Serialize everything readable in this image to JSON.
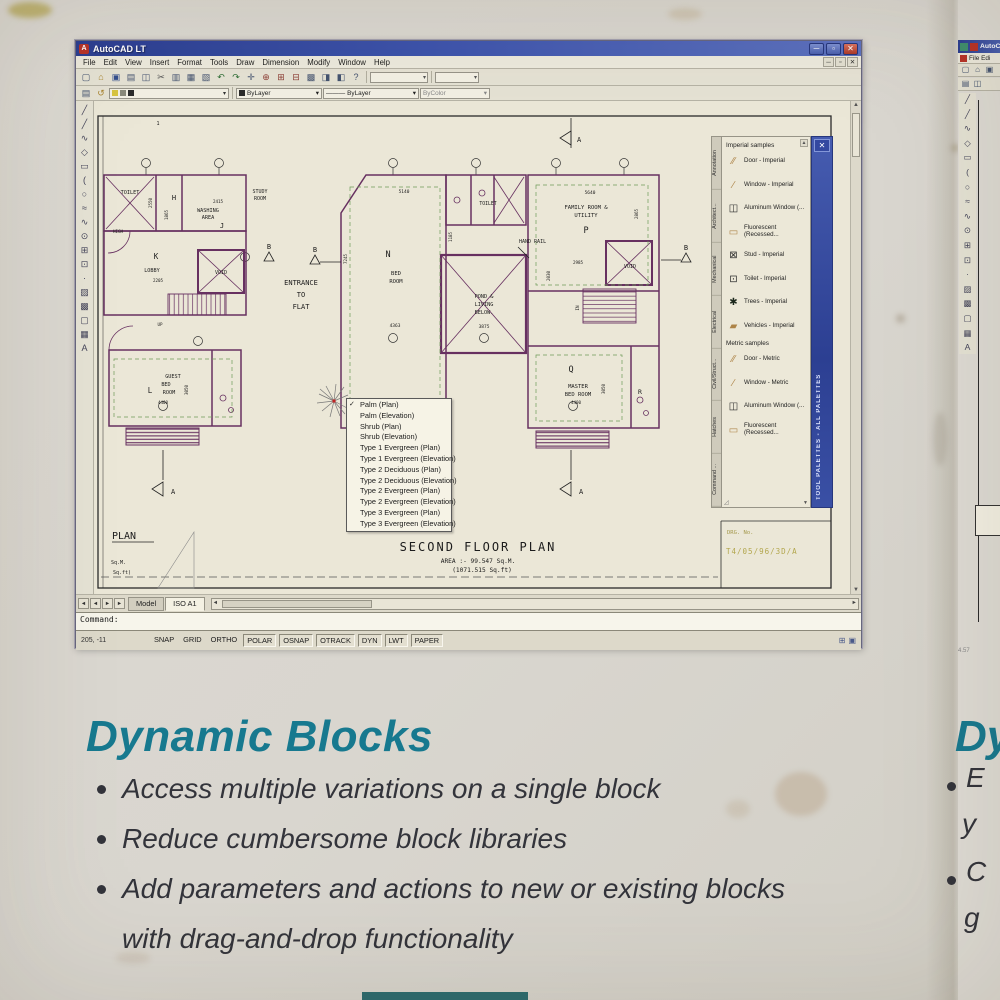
{
  "acad": {
    "title": "AutoCAD LT",
    "app_icon_letter": "A",
    "controls": {
      "minimize": "─",
      "restore": "▫",
      "close": "✕"
    },
    "doc_controls": {
      "minimize": "─",
      "restore": "▫",
      "close": "✕"
    },
    "menus": [
      "File",
      "Edit",
      "View",
      "Insert",
      "Format",
      "Tools",
      "Draw",
      "Dimension",
      "Modify",
      "Window",
      "Help"
    ],
    "toolbar1_icons": [
      {
        "name": "qnew-icon",
        "glyph": "▢"
      },
      {
        "name": "open-icon",
        "glyph": "⌂"
      },
      {
        "name": "save-icon",
        "glyph": "▣"
      },
      {
        "name": "plot-icon",
        "glyph": "▤"
      },
      {
        "name": "plot-preview-icon",
        "glyph": "◫"
      },
      {
        "name": "cut-icon",
        "glyph": "✂"
      },
      {
        "name": "copy-icon",
        "glyph": "▥"
      },
      {
        "name": "paste-icon",
        "glyph": "▦"
      },
      {
        "name": "match-properties-icon",
        "glyph": "▧"
      },
      {
        "name": "undo-icon",
        "glyph": "↶"
      },
      {
        "name": "redo-icon",
        "glyph": "↷"
      },
      {
        "name": "pan-icon",
        "glyph": "✛"
      },
      {
        "name": "zoom-realtime-icon",
        "glyph": "⊕"
      },
      {
        "name": "zoom-window-icon",
        "glyph": "⊞"
      },
      {
        "name": "zoom-previous-icon",
        "glyph": "⊟"
      },
      {
        "name": "properties-icon",
        "glyph": "▩"
      },
      {
        "name": "designcenter-icon",
        "glyph": "◨"
      },
      {
        "name": "tool-palettes-icon",
        "glyph": "◧"
      },
      {
        "name": "help-icon",
        "glyph": "?"
      }
    ],
    "combo_arrow": "▾",
    "layer_tools": [
      {
        "name": "layer-properties-icon",
        "glyph": "▤"
      },
      {
        "name": "layer-previous-icon",
        "glyph": "↺"
      }
    ],
    "properties": {
      "color_value": "ByLayer",
      "linetype_dash": "———",
      "linetype_value": "ByLayer",
      "plotstyle_value": "ByColor"
    },
    "draw_icons": [
      {
        "name": "line-icon",
        "glyph": "╱"
      },
      {
        "name": "construction-line-icon",
        "glyph": "╱"
      },
      {
        "name": "polyline-icon",
        "glyph": "∿"
      },
      {
        "name": "polygon-icon",
        "glyph": "◇"
      },
      {
        "name": "rectangle-icon",
        "glyph": "▭"
      },
      {
        "name": "arc-icon",
        "glyph": "("
      },
      {
        "name": "circle-icon",
        "glyph": "○"
      },
      {
        "name": "revision-cloud-icon",
        "glyph": "≈"
      },
      {
        "name": "spline-icon",
        "glyph": "∿"
      },
      {
        "name": "ellipse-icon",
        "glyph": "⊙"
      },
      {
        "name": "insert-block-icon",
        "glyph": "⊞"
      },
      {
        "name": "make-block-icon",
        "glyph": "⊡"
      },
      {
        "name": "point-icon",
        "glyph": "·"
      },
      {
        "name": "hatch-icon",
        "glyph": "▨"
      },
      {
        "name": "gradient-icon",
        "glyph": "▩"
      },
      {
        "name": "region-icon",
        "glyph": "▢"
      },
      {
        "name": "table-icon",
        "glyph": "▦"
      },
      {
        "name": "text-icon",
        "glyph": "A"
      }
    ],
    "command_text": "Command:",
    "tab_nav": [
      "◄",
      "◄",
      "►",
      "►"
    ],
    "tabs": {
      "model": "Model",
      "layout": "ISO A1"
    },
    "scroll": {
      "left": "◄",
      "right": "►",
      "up": "▲",
      "down": "▼"
    },
    "status": {
      "coords": "205, -11",
      "buttons": [
        {
          "label": "SNAP",
          "raised": false
        },
        {
          "label": "GRID",
          "raised": false
        },
        {
          "label": "ORTHO",
          "raised": false
        },
        {
          "label": "POLAR",
          "raised": true
        },
        {
          "label": "OSNAP",
          "raised": true
        },
        {
          "label": "OTRACK",
          "raised": true
        },
        {
          "label": "DYN",
          "raised": true
        },
        {
          "label": "LWT",
          "raised": true
        },
        {
          "label": "PAPER",
          "raised": true
        }
      ],
      "tray": [
        {
          "name": "toolbar-lock-icon",
          "glyph": "⊞"
        },
        {
          "name": "comm-center-icon",
          "glyph": "▣"
        }
      ]
    }
  },
  "palette": {
    "tabs": [
      "Annotation",
      "Architect...",
      "Mechanical",
      "Electrical",
      "Civil/Struct...",
      "Hatches",
      "Command ..."
    ],
    "bar_label": "TOOL PALETTES - ALL PALETTES",
    "header1": "Imperial samples",
    "items1": [
      {
        "name": "door-imperial-item",
        "icon": "door-icon",
        "glyph": "∕∕",
        "cls": "tan",
        "label": "Door - Imperial"
      },
      {
        "name": "window-imperial-item",
        "icon": "window-icon",
        "glyph": "∕",
        "cls": "tan",
        "label": "Window - Imperial"
      },
      {
        "name": "aluminum-window-imperial-item",
        "icon": "aluminum-window-icon",
        "glyph": "◫",
        "cls": "dark",
        "label": "Aluminum Window (..."
      },
      {
        "name": "fluorescent-imperial-item",
        "icon": "fluorescent-icon",
        "glyph": "▭",
        "cls": "tan",
        "label": "Fluorescent (Recessed..."
      },
      {
        "name": "stud-imperial-item",
        "icon": "stud-icon",
        "glyph": "⊠",
        "cls": "dark",
        "label": "Stud - Imperial"
      },
      {
        "name": "toilet-imperial-item",
        "icon": "toilet-icon",
        "glyph": "⊡",
        "cls": "dark",
        "label": "Toilet - Imperial"
      },
      {
        "name": "trees-imperial-item",
        "icon": "tree-icon",
        "glyph": "✱",
        "cls": "darkgreen",
        "label": "Trees - Imperial"
      },
      {
        "name": "vehicles-imperial-item",
        "icon": "vehicle-icon",
        "glyph": "▰",
        "cls": "tan",
        "label": "Vehicles - Imperial"
      }
    ],
    "header2": "Metric samples",
    "items2": [
      {
        "name": "door-metric-item",
        "icon": "door-icon",
        "glyph": "∕∕",
        "cls": "tan",
        "label": "Door - Metric"
      },
      {
        "name": "window-metric-item",
        "icon": "window-icon",
        "glyph": "∕",
        "cls": "tan",
        "label": "Window - Metric"
      },
      {
        "name": "aluminum-window-metric-item",
        "icon": "aluminum-window-icon",
        "glyph": "◫",
        "cls": "dark",
        "label": "Aluminum Window (..."
      },
      {
        "name": "fluorescent-metric-item",
        "icon": "fluorescent-icon",
        "glyph": "▭",
        "cls": "tan",
        "label": "Fluorescent (Recessed..."
      }
    ]
  },
  "block_menu": {
    "items": [
      {
        "label": "Palm (Plan)",
        "checked": true
      },
      {
        "label": "Palm (Elevation)",
        "checked": false
      },
      {
        "label": "Shrub (Plan)",
        "checked": false
      },
      {
        "label": "Shrub (Elevation)",
        "checked": false
      },
      {
        "label": "Type 1 Evergreen (Plan)",
        "checked": false
      },
      {
        "label": "Type 1 Evergreen (Elevation)",
        "checked": false
      },
      {
        "label": "Type 2 Deciduous (Plan)",
        "checked": false
      },
      {
        "label": "Type 2 Deciduous (Elevation)",
        "checked": false
      },
      {
        "label": "Type 2 Evergreen (Plan)",
        "checked": false
      },
      {
        "label": "Type 2 Evergreen (Elevation)",
        "checked": false
      },
      {
        "label": "Type 3 Evergreen (Plan)",
        "checked": false
      },
      {
        "label": "Type 3 Evergreen (Elevation)",
        "checked": false
      }
    ]
  },
  "plan": {
    "title": "SECOND FLOOR PLAN",
    "area1": "AREA :- 99.547 Sq.M.",
    "area2": "(1071.515 Sq.ft)",
    "drg_label": "DRG. No.",
    "drg_value": "T4/05/96/3D/A",
    "labels": {
      "one": "1",
      "toilet_left": "TOILET",
      "h": "H",
      "washing": "WASHING",
      "area_word": "AREA",
      "j": "J",
      "study1": "STUDY",
      "study2": "ROOM",
      "high": "HIGH",
      "k": "K",
      "lobby": "LOBBY",
      "void_left": "VOID",
      "up": "UP",
      "guest1": "GUEST",
      "guest2": "BED",
      "guest3": "ROOM",
      "l": "L",
      "n": "N",
      "bed1": "BED",
      "bed2": "ROOM",
      "toilet_top": "TOILET",
      "pond1": "POND &",
      "pond2": "LIVING",
      "pond3": "BELOW.",
      "hand_rail": "HAND RAIL",
      "entrance1": "ENTRANCE",
      "entrance2": "TO",
      "entrance3": "FLAT",
      "family1": "FAMILY ROOM &",
      "family2": "UTILITY",
      "p": "P",
      "void_right": "VOID",
      "in_word": "IN",
      "master1": "MASTER",
      "master2": "BED ROOM",
      "q": "Q",
      "r": "R",
      "a": "A",
      "b": "B",
      "plan_word": "PLAN",
      "sqm": "Sq.M.",
      "sqft": "Sq.ft)"
    },
    "dims": {
      "d2550": "2550",
      "d1865": "1865",
      "d2415": "2415",
      "d2205": "2205",
      "d4400g": "4400",
      "d3050g": "3050",
      "d5140": "5140",
      "d7245": "7245",
      "d4363": "4363",
      "d1185": "1185",
      "d3875": "3875",
      "d5640": "5640",
      "d2865": "2865",
      "d2985": "2985",
      "d2030": "2030",
      "d4400m": "4400",
      "d3050m": "3050"
    }
  },
  "caption": {
    "heading": "Dynamic Blocks",
    "bullets": [
      "Access multiple variations on a single block",
      "Reduce cumbersome block libraries",
      "Add parameters and actions to new or existing blocks with drag-and-drop functionality"
    ]
  },
  "right_panel": {
    "title": "AutoCA",
    "menu_file": "File Edi",
    "heading": "Dy",
    "line1_start": "E",
    "line1_wrap": "y",
    "line2_start": "C",
    "line2_wrap": "g",
    "corner_num": "4.57",
    "icons_row1": [
      "▢",
      "⌂",
      "▣"
    ],
    "icons_row2": [
      "▤",
      "◫"
    ]
  }
}
